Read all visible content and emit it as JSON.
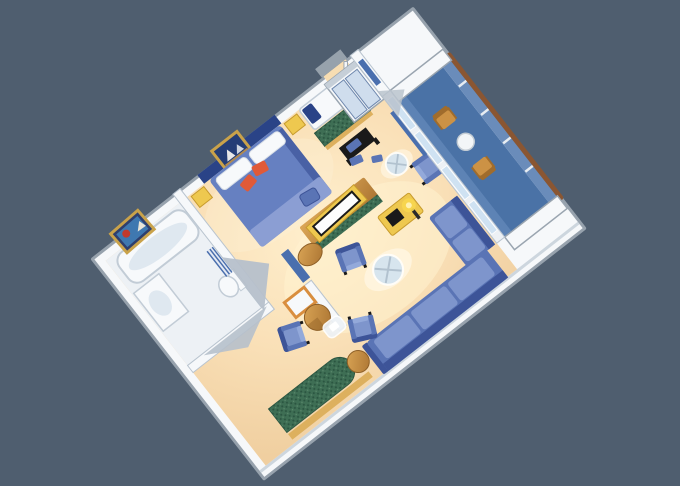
{
  "scene": {
    "kind": "isometric-floor-plan-illustration",
    "description": "3D cutaway floor plan of a cruise ship grand suite with bedroom, bathroom, dressing area, living area and private balcony",
    "background_color": "#4f5e6f",
    "colors": {
      "background": "#4f5e6f",
      "wall_edge": "#97a2ad",
      "wall_white": "#f6f8fa",
      "wall_shade": "#c6cfd8",
      "wall_wedge": "#b6c0cb",
      "bath_floor": "#edf1f5",
      "floor_warm": "#f7ddb2",
      "floor_light": "#ffefcd",
      "floor_shadow": "#f0cfa0",
      "navy": "#2a4387",
      "bed_blue": "#6680c1",
      "bed_fold": "#8b9ed3",
      "sofa_blue": "#5a74b5",
      "sofa_cushion": "#7e95cc",
      "sofa_dark": "#3d5498",
      "sofa_light": "#93a9da",
      "pillow_white": "#f7f9fb",
      "accent_orange": "#e05a38",
      "green_upholstery": "#3e6e54",
      "green_dark": "#2a5440",
      "wood": "#cc9245",
      "wood_dark": "#a06c2c",
      "trim_wood": "#ddb05e",
      "trim_yellow": "#eec84f",
      "rail_brown": "#8a5632",
      "balcony_deck": "#4a72a6",
      "balcony_deck_light": "#5d83b5",
      "parapet_blue": "#6a8cba",
      "glass_blue": "#cfe2f2",
      "door_blue": "#cfdded",
      "blue_accent": "#4a6fae",
      "black": "#1a1a1a",
      "lamp_yellow": "#f7d64e",
      "frame_gold": "#c9a24a",
      "mirror_frame": "#d98e3e"
    }
  },
  "plan": {
    "rooms": [
      {
        "name": "bathroom",
        "furniture": [
          "bathtub",
          "sink-vanity",
          "toilet",
          "shower-curtain",
          "wall-art"
        ]
      },
      {
        "name": "dressing-area",
        "furniture": [
          "vanity-mirror",
          "wood-drum-stool",
          "wardrobe-door"
        ]
      },
      {
        "name": "bedroom",
        "furniture": [
          "queen-bed",
          "headboard",
          "nightstand-left",
          "nightstand-right",
          "wall-art",
          "ottoman"
        ]
      },
      {
        "name": "window-nook",
        "furniture": [
          "day-bed",
          "green-bench",
          "black-coffee-table"
        ]
      },
      {
        "name": "entry",
        "furniture": [
          "entry-door",
          "closet",
          "floor-mats"
        ]
      },
      {
        "name": "living-area",
        "furniture": [
          "tv-cabinet",
          "sectional-sofa",
          "armchair",
          "armchair",
          "armchair",
          "armchair",
          "glass-coffee-table",
          "glass-table",
          "side-table",
          "chaise-lounge",
          "desk",
          "floor-lamp"
        ]
      },
      {
        "name": "balcony",
        "furniture": [
          "deck-chair",
          "deck-chair",
          "patio-table",
          "railing",
          "glass-doors"
        ]
      }
    ]
  }
}
